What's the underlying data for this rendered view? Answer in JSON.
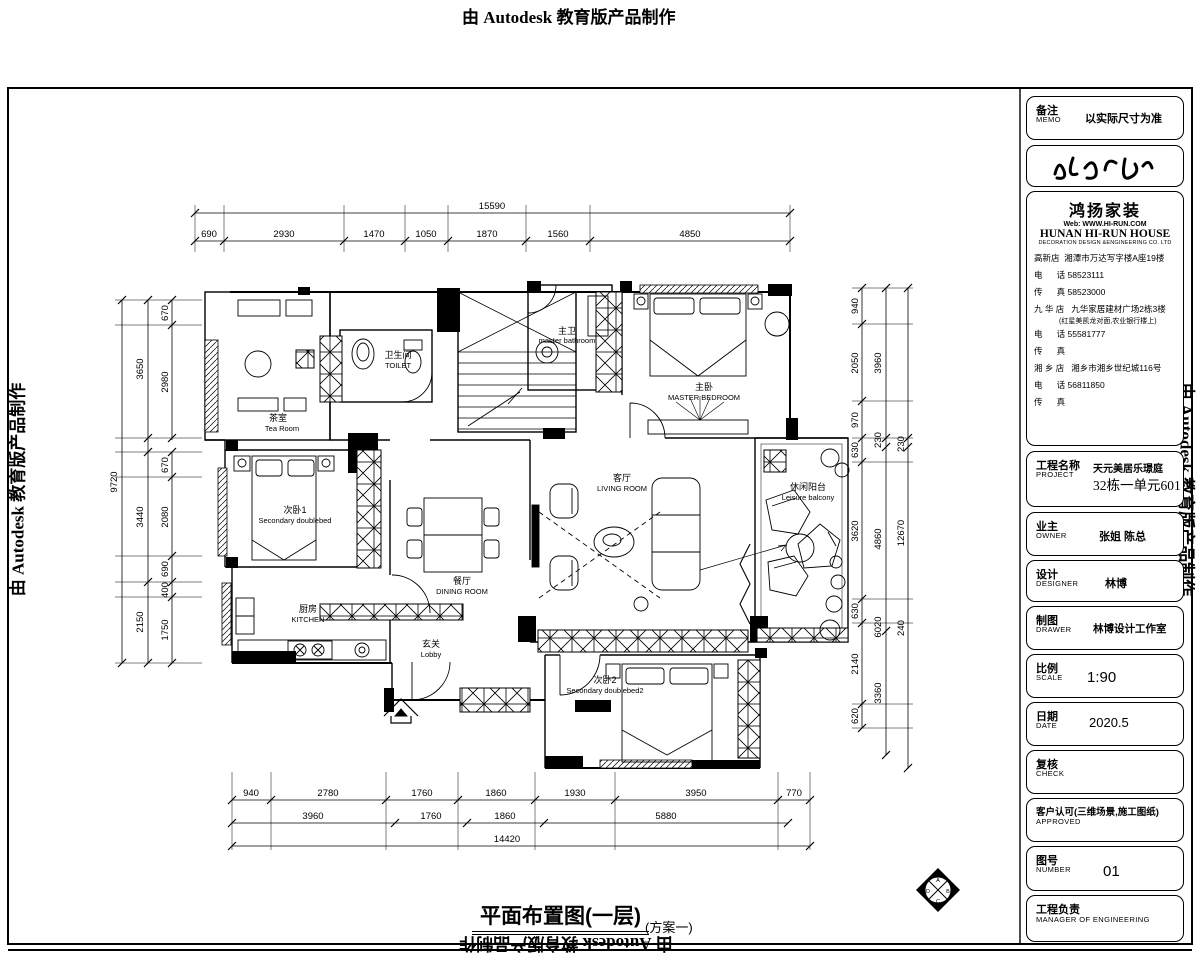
{
  "colors": {
    "ink": "#000000",
    "paper": "#ffffff"
  },
  "watermarks": {
    "top": "由 Autodesk 教育版产品制作",
    "left": "由 Autodesk 教育版产品制作",
    "right": "由 Autodesk 教育版产品制作",
    "bottom": "由 Autodesk 教育版产品制作"
  },
  "caption": {
    "title": "平面布置图(一层)",
    "scheme": "(方案一)"
  },
  "rooms": {
    "tea": {
      "cn": "茶室",
      "en": "Tea Room"
    },
    "toilet": {
      "cn": "卫生间",
      "en": "TOILET"
    },
    "masterbath": {
      "cn": "主卫",
      "en": "master bathroom"
    },
    "master": {
      "cn": "主卧",
      "en": "MASTER BEDROOM"
    },
    "living": {
      "cn": "客厅",
      "en": "LIVING ROOM"
    },
    "balcony": {
      "cn": "休闲阳台",
      "en": "Leisure balcony"
    },
    "bed1": {
      "cn": "次卧1",
      "en": "Secondary doublebed"
    },
    "dining": {
      "cn": "餐厅",
      "en": "DINING ROOM"
    },
    "kitchen": {
      "cn": "厨房",
      "en": "KITCHEN"
    },
    "lobby": {
      "cn": "玄关",
      "en": "Lobby"
    },
    "bed2": {
      "cn": "次卧2",
      "en": "Secondary doublebed2"
    }
  },
  "dims": {
    "top": {
      "total": "15590",
      "segments": [
        "690",
        "2930",
        "1470",
        "1050",
        "1870",
        "1560",
        "4850"
      ]
    },
    "bottom": {
      "row1": [
        "940",
        "2780",
        "1760",
        "1860",
        "1930",
        "3950",
        "770"
      ],
      "row2": [
        "3960",
        "1760",
        "1860",
        "5880"
      ],
      "total": "14420"
    },
    "left": {
      "overall": "9720",
      "mid": [
        "3650",
        "3440",
        "2150"
      ],
      "inner": [
        "670",
        "2980",
        "670",
        "2080",
        "690",
        "400",
        "1750"
      ]
    },
    "right": {
      "inner": [
        "940",
        "2050",
        "970",
        "630",
        "3620",
        "630",
        "2140",
        "620"
      ],
      "mid": [
        "3960",
        "230",
        "4860",
        "6020",
        "3360"
      ],
      "outer": [
        "230",
        "12670",
        "240"
      ]
    }
  },
  "titleblock": {
    "memo": {
      "cn": "备注",
      "en": "MEMO",
      "value": "以实际尺寸为准"
    },
    "brand": {
      "name": "鸿扬家装",
      "web": "Web: WWW.HI-RUN.COM",
      "company": "HUNAN HI-RUN HOUSE",
      "company_sub": "DECORATION DESIGN &ENGINEERING CO. LTD",
      "lines": [
        "高新店  湘潭市万达写字楼A座19楼",
        "电      话 58523111",
        "传      真 58523000",
        "九 华 店   九华家居建材广场2栋3楼",
        "(红星美凯龙对面,农业银行楼上)",
        "电      话 55581777",
        "传      真",
        "湘 乡 店   湘乡市湘乡世纪城116号",
        "电      话 56811850",
        "传      真"
      ]
    },
    "project": {
      "cn": "工程名称",
      "en": "PROJECT",
      "line1": "天元美居乐璟庭",
      "line2": "32栋一单元601"
    },
    "owner": {
      "cn": "业主",
      "en": "OWNER",
      "value": "张姐  陈总"
    },
    "designer": {
      "cn": "设计",
      "en": "DESIGNER",
      "value": "林博"
    },
    "drawer": {
      "cn": "制图",
      "en": "DRAWER",
      "value": "林博设计工作室"
    },
    "scale": {
      "cn": "比例",
      "en": "SCALE",
      "value": "1:90"
    },
    "date": {
      "cn": "日期",
      "en": "DATE",
      "value": "2020.5"
    },
    "check": {
      "cn": "复核",
      "en": "CHECK",
      "value": ""
    },
    "approved": {
      "cn": "客户认可(三维场景,施工图纸)",
      "en": "APPROVED",
      "value": ""
    },
    "number": {
      "cn": "图号",
      "en": "NUMBER",
      "value": "01"
    },
    "manager": {
      "cn": "工程负责",
      "en": "MANAGER  OF  ENGINEERING",
      "value": ""
    }
  }
}
